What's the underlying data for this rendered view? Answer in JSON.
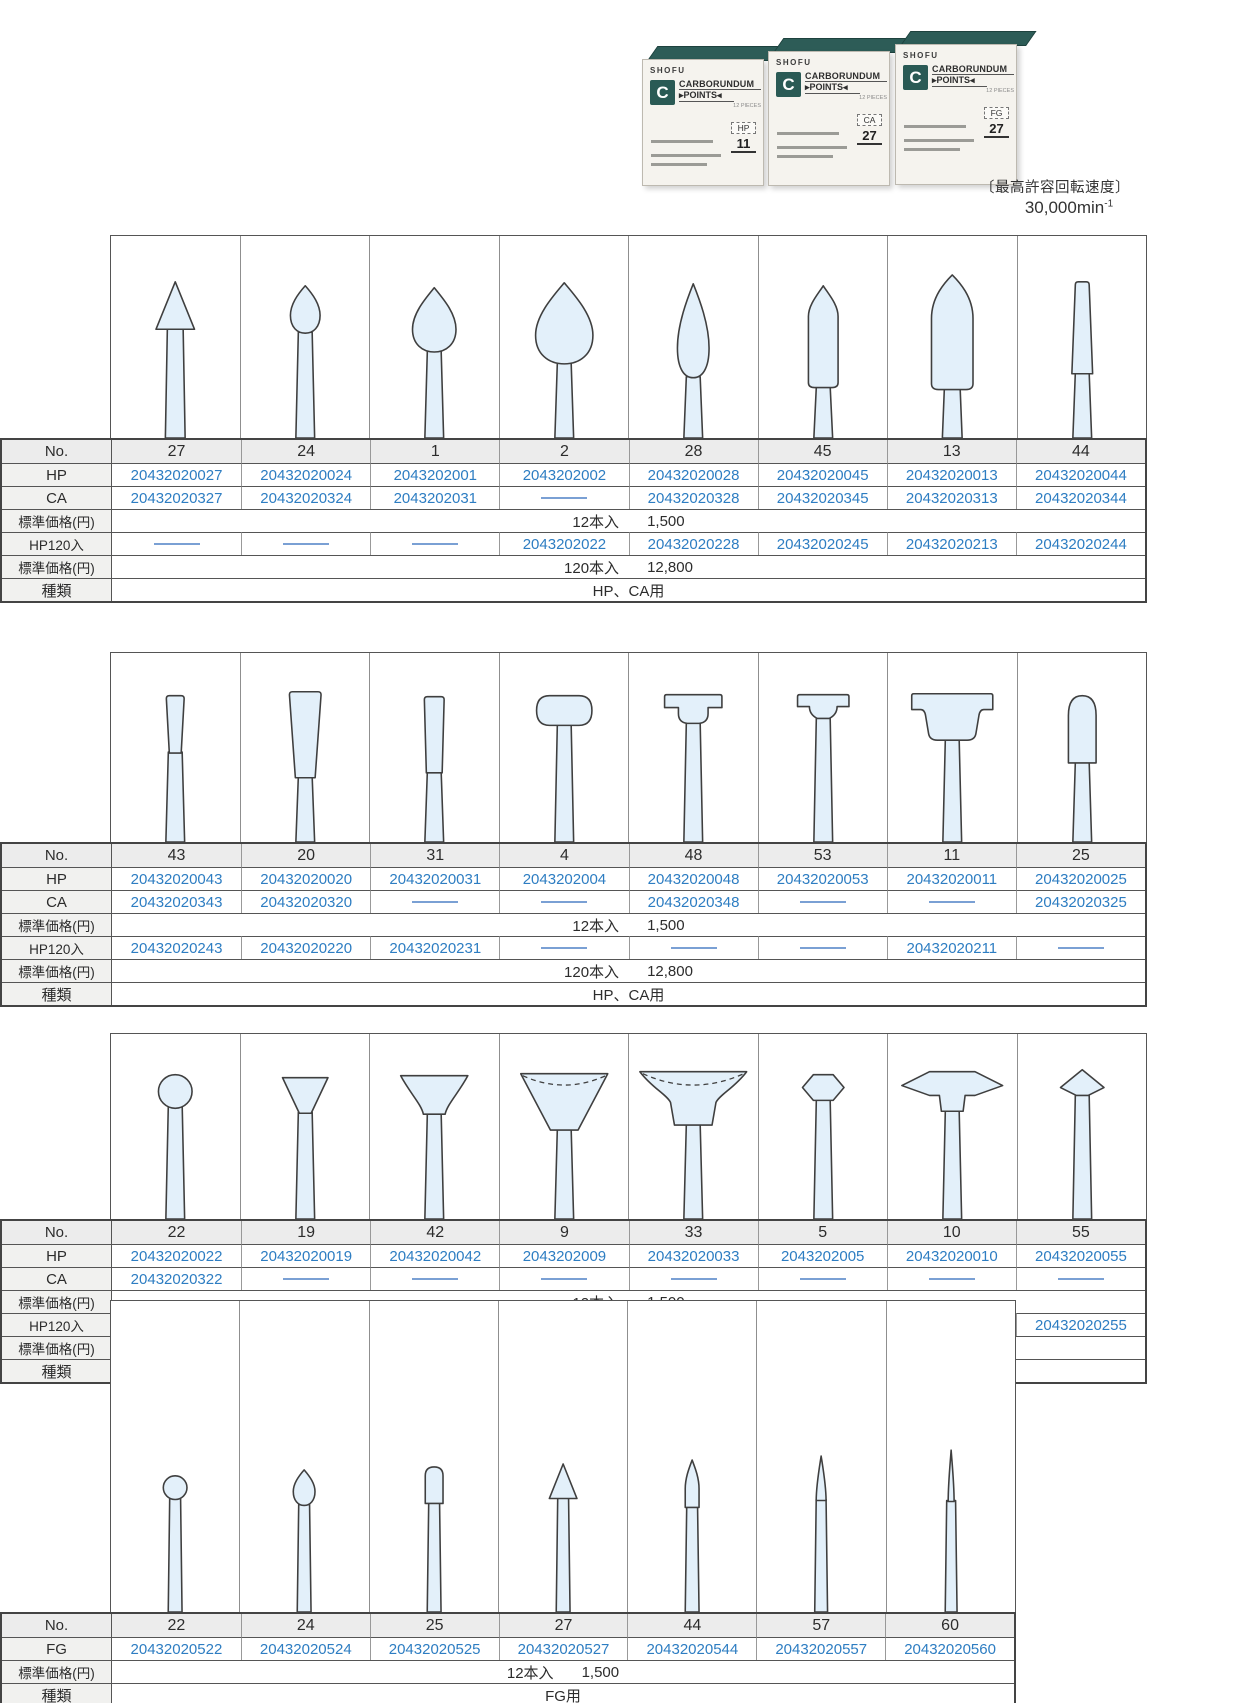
{
  "header": {
    "speed_note": {
      "label": "〔最高許容回転速度〕",
      "value": "30,000min",
      "sup": "-1"
    },
    "photo": {
      "boxes": [
        {
          "brand": "SHOFU",
          "logo": "C",
          "line1": "CARBORUNDUM",
          "line2": "▸POINTS◂",
          "pieces": "12 PIECES",
          "type": "HP",
          "no": "11"
        },
        {
          "brand": "SHOFU",
          "logo": "C",
          "line1": "CARBORUNDUM",
          "line2": "▸POINTS◂",
          "pieces": "12 PIECES",
          "type": "CA",
          "no": "27"
        },
        {
          "brand": "SHOFU",
          "logo": "C",
          "line1": "CARBORUNDUM",
          "line2": "▸POINTS◂",
          "pieces": "12 PIECES",
          "type": "FG",
          "no": "27"
        }
      ]
    }
  },
  "colors": {
    "link_blue": "#2d7dc2",
    "box_teal": "#2d5c57",
    "shape_fill": "#e3f0fa"
  },
  "tables": [
    {
      "kind": "HP・CA points group 1",
      "no_label": "No.",
      "columns": [
        {
          "no": "27",
          "shape": "cone-point"
        },
        {
          "no": "24",
          "shape": "bud"
        },
        {
          "no": "1",
          "shape": "pear-small"
        },
        {
          "no": "2",
          "shape": "pear-large"
        },
        {
          "no": "28",
          "shape": "flame-long"
        },
        {
          "no": "45",
          "shape": "bullet"
        },
        {
          "no": "13",
          "shape": "torpedo"
        },
        {
          "no": "44",
          "shape": "taper-cylinder"
        }
      ],
      "rows": [
        {
          "label": "HP",
          "cells": [
            "20432020027",
            "20432020024",
            "2043202001",
            "2043202002",
            "20432020028",
            "20432020045",
            "20432020013",
            "20432020044"
          ]
        },
        {
          "label": "CA",
          "cells": [
            "20432020327",
            "20432020324",
            "2043202031",
            "——",
            "20432020328",
            "20432020345",
            "20432020313",
            "20432020344"
          ]
        },
        {
          "label": "標準価格(円)",
          "span": [
            "12本入",
            "1,500"
          ]
        },
        {
          "label": "HP120入",
          "cells": [
            "——",
            "——",
            "——",
            "2043202022",
            "20432020228",
            "20432020245",
            "20432020213",
            "20432020244"
          ]
        },
        {
          "label": "標準価格(円)",
          "span": [
            "120本入",
            "12,800"
          ]
        },
        {
          "label": "種類",
          "span": [
            "HP、CA用"
          ]
        }
      ]
    },
    {
      "kind": "HP・CA points group 2",
      "no_label": "No.",
      "columns": [
        {
          "no": "43",
          "shape": "taper-small"
        },
        {
          "no": "20",
          "shape": "taper-large"
        },
        {
          "no": "31",
          "shape": "cylinder"
        },
        {
          "no": "4",
          "shape": "pill-wheel"
        },
        {
          "no": "48",
          "shape": "step-tee"
        },
        {
          "no": "53",
          "shape": "flat-tee"
        },
        {
          "no": "11",
          "shape": "wide-tee"
        },
        {
          "no": "25",
          "shape": "dome-cylinder"
        }
      ],
      "rows": [
        {
          "label": "HP",
          "cells": [
            "20432020043",
            "20432020020",
            "20432020031",
            "2043202004",
            "20432020048",
            "20432020053",
            "20432020011",
            "20432020025"
          ]
        },
        {
          "label": "CA",
          "cells": [
            "20432020343",
            "20432020320",
            "——",
            "——",
            "20432020348",
            "——",
            "——",
            "20432020325"
          ]
        },
        {
          "label": "標準価格(円)",
          "span": [
            "12本入",
            "1,500"
          ]
        },
        {
          "label": "HP120入",
          "cells": [
            "20432020243",
            "20432020220",
            "20432020231",
            "——",
            "——",
            "——",
            "20432020211",
            "——"
          ]
        },
        {
          "label": "標準価格(円)",
          "span": [
            "120本入",
            "12,800"
          ]
        },
        {
          "label": "種類",
          "span": [
            "HP、CA用"
          ]
        }
      ]
    },
    {
      "kind": "HP・CA points group 3",
      "no_label": "No.",
      "columns": [
        {
          "no": "22",
          "shape": "ball"
        },
        {
          "no": "19",
          "shape": "inv-cone-small"
        },
        {
          "no": "42",
          "shape": "inv-cone"
        },
        {
          "no": "9",
          "shape": "cup-cone"
        },
        {
          "no": "33",
          "shape": "cup-wide"
        },
        {
          "no": "5",
          "shape": "hexagon"
        },
        {
          "no": "10",
          "shape": "knife-wheel"
        },
        {
          "no": "55",
          "shape": "spear"
        }
      ],
      "rows": [
        {
          "label": "HP",
          "cells": [
            "20432020022",
            "20432020019",
            "20432020042",
            "2043202009",
            "20432020033",
            "2043202005",
            "20432020010",
            "20432020055"
          ]
        },
        {
          "label": "CA",
          "cells": [
            "20432020322",
            "——",
            "——",
            "——",
            "——",
            "——",
            "——",
            "——"
          ]
        },
        {
          "label": "標準価格(円)",
          "span": [
            "12本入",
            "1,500"
          ]
        },
        {
          "label": "HP120入",
          "cells": [
            "——",
            "20432020219",
            "20432020242",
            "2043202029",
            "20432020233",
            "——",
            "20432020210",
            "20432020255"
          ]
        },
        {
          "label": "標準価格(円)",
          "span": [
            "120本入",
            "12,800"
          ]
        },
        {
          "label": "種類",
          "span": [
            "HP、CA用"
          ]
        }
      ]
    },
    {
      "kind": "FG points",
      "no_label": "No.",
      "columns": [
        {
          "no": "22",
          "shape": "ball-small"
        },
        {
          "no": "24",
          "shape": "bud-small"
        },
        {
          "no": "25",
          "shape": "round-cylinder-small"
        },
        {
          "no": "27",
          "shape": "cone-small"
        },
        {
          "no": "44",
          "shape": "flame-small"
        },
        {
          "no": "57",
          "shape": "taper-point-small"
        },
        {
          "no": "60",
          "shape": "needle-small"
        }
      ],
      "rows": [
        {
          "label": "FG",
          "cells": [
            "20432020522",
            "20432020524",
            "20432020525",
            "20432020527",
            "20432020544",
            "20432020557",
            "20432020560"
          ]
        },
        {
          "label": "標準価格(円)",
          "span": [
            "12本入",
            "1,500"
          ]
        },
        {
          "label": "種類",
          "span": [
            "FG用"
          ]
        }
      ]
    }
  ]
}
